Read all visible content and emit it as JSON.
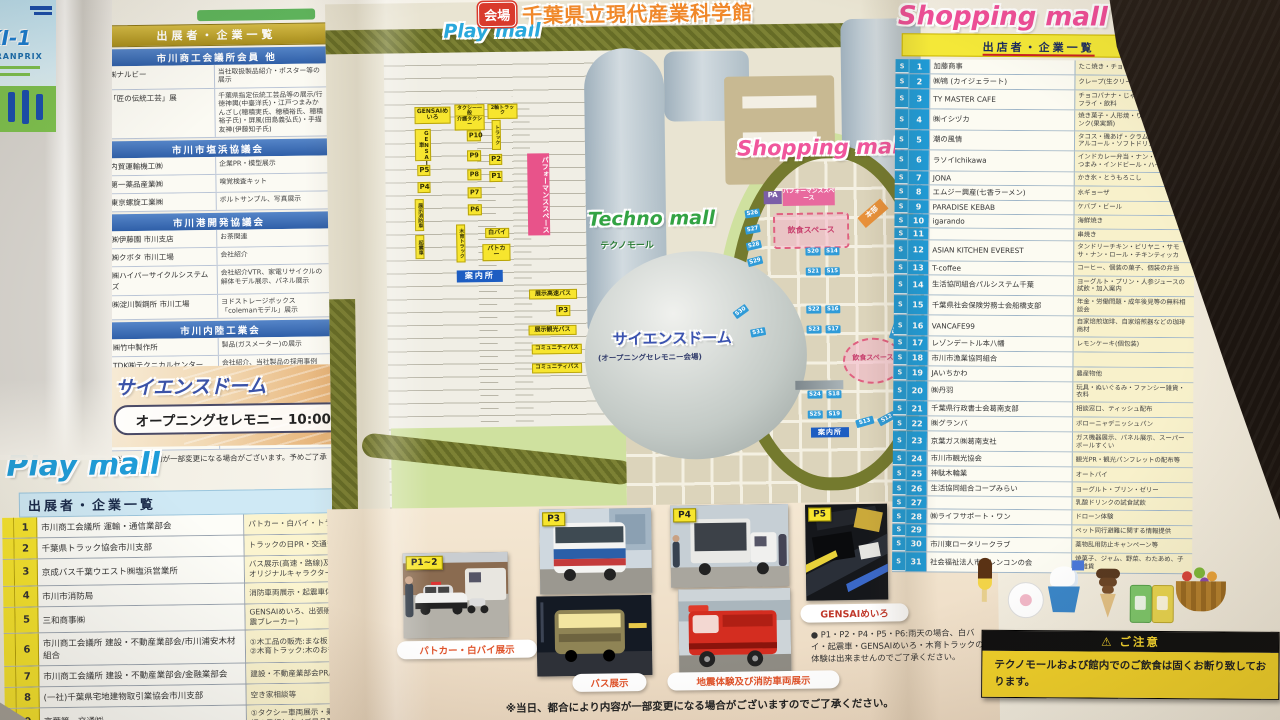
{
  "colors": {
    "play_blue": "#1f9cd8",
    "techno_green": "#33a344",
    "shopping_pink": "#f04f98",
    "title_orange": "#f0882a",
    "caution_yellow": "#f0d02a",
    "stall_blue": "#1f9bd7",
    "parking_yellow": "#f7e52e"
  },
  "header": {
    "badge": "会場",
    "title": "千葉県立現代産業科学館"
  },
  "flyer": {
    "line1": "KI-1",
    "line2": "GRANPRIX"
  },
  "exhibitors": {
    "title": "出展者・企業一覧",
    "note": "※当日、展示物が一部変更になる場合がございます。予めご了承ください。",
    "sections": [
      {
        "header": "市川商工会議所会員 他",
        "rows": [
          {
            "name": "㈱ナルビー",
            "desc": "当社取扱製品紹介・ポスター等の展示"
          },
          {
            "name": "「匠の伝統工芸」展",
            "desc": "千葉県指定伝統工芸品等の展示/行徳神輿(中臺洋氏)・江戸つまみかんざし(穂積実氏、穂積裕氏、穂積裕子氏)・屏風(田島義弘氏)・手描友禅(伊藤知子氏)"
          }
        ]
      },
      {
        "header": "市川市塩浜協議会",
        "rows": [
          {
            "name": "内貿運輸機工㈱",
            "desc": "企業PR・模型展示"
          },
          {
            "name": "第一薬品産業㈱",
            "desc": "嗅覚検査キット"
          },
          {
            "name": "東京螺旋工業㈱",
            "desc": "ボルトサンプル、写真展示"
          }
        ]
      },
      {
        "header": "市川港開発協議会",
        "rows": [
          {
            "name": "㈱伊藤園 市川支店",
            "desc": "お茶関連"
          },
          {
            "name": "㈱クボタ 市川工場",
            "desc": "会社紹介"
          },
          {
            "name": "㈱ハイパーサイクルシステムズ",
            "desc": "会社紹介VTR、家電リサイクルの解体モデル展示、パネル展示"
          },
          {
            "name": "㈱淀川製鋼所 市川工場",
            "desc": "ヨドストレージボックス「colemanモデル」展示"
          }
        ]
      },
      {
        "header": "市川内陸工業会",
        "rows": [
          {
            "name": "㈱竹中製作所",
            "desc": "製品(ガスメーター)の展示"
          },
          {
            "name": "TDK㈱テクニカルセンター",
            "desc": "会社紹介、当社製品の採用事例"
          }
        ]
      },
      {
        "header": "市川臨海工業会",
        "rows": [
          {
            "name": "東洋合成工業㈱",
            "desc": "パネル・製品関係(イメージ)の展示、会社紹介動画の放映など"
          },
          {
            "name": "㈱市川環境エンジニアリング",
            "desc": "パネル展示、会社案内動画放映、ワークショップ(グラスガーデン、ぷんぷんごま作り)"
          }
        ]
      }
    ]
  },
  "science_dome": {
    "title": "サイエンスドーム",
    "event": "オープニングセレモニー 10:00"
  },
  "play_mall": {
    "title": "Play mall",
    "subtitle": "出展者・企業一覧",
    "rows": [
      {
        "no": "1",
        "name": "市川商工会議所 運輸・通信業部会",
        "desc": "パトカー・白バイ・トラック展示"
      },
      {
        "no": "2",
        "name": "千葉県トラック協会市川支部",
        "desc": "トラックの日PR・交通安全・啓蒙活動"
      },
      {
        "no": "3",
        "name": "京成バス千葉ウエスト㈱塩浜営業所",
        "desc": "バス展示(高速・路線)及び乗車体験、グッズ販売 塩浜営業所オリジナルキャラクター「トラにゃ」交流会"
      },
      {
        "no": "4",
        "name": "市川市消防局",
        "desc": "消防車両展示・起震車体験"
      },
      {
        "no": "5",
        "name": "三和商事㈱",
        "desc": "GENSAIめいろ、出張販売Car GENSAI、防災用品の展示(感震ブレーカー)"
      },
      {
        "no": "6",
        "name": "市川商工会議所 建設・不動産業部会/市川浦安木材組合",
        "desc": "①木工品の販売:まな板・木のおもちゃ(木製品小物 展示販売) ②木育トラック:木のおもちゃ展示【体験】"
      },
      {
        "no": "7",
        "name": "市川商工会議所 建設・不動産業部会/金融業部会",
        "desc": "建設・不動産業部会PR/金融業部会PR"
      },
      {
        "no": "8",
        "name": "(一社)千葉県宅地建物取引業協会市川支部",
        "desc": "空き家相談等"
      },
      {
        "no": "9",
        "name": "京葉第一交通㈱",
        "desc": "①タクシー車両展示・乗車体験2台(介護、一般) ②子供乗務員証の発行とクイズ景品配布 ③タクマと記念撮影"
      }
    ]
  },
  "shopping_mall": {
    "title": "Shopping mall",
    "subtitle": "出店者・企業一覧",
    "rows": [
      {
        "s": "S",
        "no": "1",
        "name": "加藤商事",
        "desc": "たこ焼き・チョコバナナ"
      },
      {
        "s": "S",
        "no": "2",
        "name": "㈱鴇 (カイジェラート)",
        "desc": "クレープ(生クリーム不使用)"
      },
      {
        "s": "S",
        "no": "3",
        "name": "TY MASTER CAFE",
        "desc": "チョコバナナ・じゃがバター・ポテトフライ・飲料"
      },
      {
        "s": "S",
        "no": "4",
        "name": "㈱イシヅカ",
        "desc": "焼き菓子・人形焼・りんごあめ・ドリンク(果実類)"
      },
      {
        "s": "S",
        "no": "5",
        "name": "潮の風情",
        "desc": "タコス・磯あげ・クラムチャウダー・アルコール・ソフトドリンク"
      },
      {
        "s": "S",
        "no": "6",
        "name": "ラソイIchikawa",
        "desc": "インドカレー弁当・ナン・インド風おつまみ・インドビール・ハイボール"
      },
      {
        "s": "S",
        "no": "7",
        "name": "JONA",
        "desc": "かき氷・とうもろこし"
      },
      {
        "s": "S",
        "no": "8",
        "name": "エムジー興産(七香ラーメン)",
        "desc": "水ギョーザ"
      },
      {
        "s": "S",
        "no": "9",
        "name": "PARADISE KEBAB",
        "desc": "ケバブ・ビール"
      },
      {
        "s": "S",
        "no": "10",
        "name": "igarando",
        "desc": "海鮮焼き"
      },
      {
        "s": "S",
        "no": "11",
        "name": "",
        "desc": "串焼き"
      },
      {
        "s": "S",
        "no": "12",
        "name": "ASIAN KITCHEN EVEREST",
        "desc": "タンドリーチキン・ビリヤニ・サモサ・ナン・ロール・チキンティッカ"
      },
      {
        "s": "S",
        "no": "13",
        "name": "T-coffee",
        "desc": "コーヒー、個装の菓子、個装の弁当"
      },
      {
        "s": "S",
        "no": "14",
        "name": "生活協同組合パルシステム千葉",
        "desc": "ヨーグルト・プリン・人参ジュースの試飲・加入案内"
      },
      {
        "s": "S",
        "no": "15",
        "name": "千葉県社会保険労務士会船橋支部",
        "desc": "年金・労働問題・成年後見等の無料相談会"
      },
      {
        "s": "S",
        "no": "16",
        "name": "VANCAFE99",
        "desc": "自家焙煎珈琲、自家焙煎器などの珈琲商材"
      },
      {
        "s": "S",
        "no": "17",
        "name": "レゾンデートル本八幡",
        "desc": "レモンケーキ(個包装)"
      },
      {
        "s": "S",
        "no": "18",
        "name": "市川市漁業協同組合",
        "desc": ""
      },
      {
        "s": "S",
        "no": "19",
        "name": "JAいちかわ",
        "desc": "農産物他"
      },
      {
        "s": "S",
        "no": "20",
        "name": "㈱丹羽",
        "desc": "玩具・ぬいぐるみ・ファンシー雑貨・衣料"
      },
      {
        "s": "S",
        "no": "21",
        "name": "千葉県行政書士会葛南支部",
        "desc": "相談窓口、ティッシュ配布"
      },
      {
        "s": "S",
        "no": "22",
        "name": "㈱グランバ",
        "desc": "ボローニャデニッシュパン"
      },
      {
        "s": "S",
        "no": "23",
        "name": "京葉ガス㈱葛南支社",
        "desc": "ガス機器展示、パネル展示、スーパーボールすくい"
      },
      {
        "s": "S",
        "no": "24",
        "name": "市川市観光協会",
        "desc": "観光PR・観光パンフレットの配布等"
      },
      {
        "s": "S",
        "no": "25",
        "name": "神駄木輪業",
        "desc": "オートバイ"
      },
      {
        "s": "S",
        "no": "26",
        "name": "生活協同組合コープみらい",
        "desc": "ヨーグルト・プリン・ゼリー"
      },
      {
        "s": "S",
        "no": "27",
        "name": "",
        "desc": "乳酸ドリンクの試食試飲"
      },
      {
        "s": "S",
        "no": "28",
        "name": "㈱ライフサポート・ワン",
        "desc": "ドローン体験"
      },
      {
        "s": "S",
        "no": "29",
        "name": "",
        "desc": "ペット同行避難に関する情報提供"
      },
      {
        "s": "S",
        "no": "30",
        "name": "市川東ロータリークラブ",
        "desc": "薬物乱用防止キャンペーン等"
      },
      {
        "s": "S",
        "no": "31",
        "name": "社会福祉法人市川レンコンの会",
        "desc": "焼菓子、ジャム、野菜、わたあめ、子供雑貨"
      }
    ]
  },
  "map": {
    "area_labels": {
      "play_mall": "Play mall",
      "techno_mall": "Techno mall",
      "techno_mall_jp": "テクノモール",
      "shopping_mall": "Shopping mall",
      "science_dome": "サイエンスドーム",
      "science_dome_sub": "(オープニングセレモニー会場)"
    },
    "parking": [
      "GENSAIめいろ",
      "GENSAI車",
      "P5",
      "P4",
      "展示消防車",
      "起震車",
      "タクシー一般",
      "介護タクシー",
      "P10",
      "P9",
      "P8",
      "P7",
      "P6",
      "木育トラック",
      "2軸トラック",
      "トラック",
      "P2",
      "P1",
      "白バイ",
      "パトカー",
      "展示高速バス",
      "P3",
      "展示観光バス",
      "コミュニティバス",
      "コミュニティバス"
    ],
    "info": [
      "案内所",
      "案内所"
    ],
    "performance_label": "パフォーマンススペース",
    "pa": "PA",
    "honbu": "本部",
    "eat_space": "飲食スペース",
    "stalls_left": [
      "S26",
      "S27",
      "S28",
      "S29",
      "S30",
      "S31"
    ],
    "stalls_grid": [
      "S20",
      "S14",
      "S21",
      "S15",
      "S22",
      "S16",
      "S23",
      "S17",
      "S24",
      "S18",
      "S25",
      "S19"
    ],
    "stalls_right": [
      "S1",
      "S2",
      "S3",
      "S4",
      "S5",
      "S6",
      "S7",
      "S8",
      "S9",
      "S10",
      "S11",
      "S12",
      "S13"
    ]
  },
  "photo_strip": {
    "badges": [
      "P1~2",
      "P3",
      "P4",
      "P5"
    ],
    "captions": [
      "パトカー・白バイ展示",
      "バス展示",
      "地震体験及び消防車両展示",
      "GENSAIめいろ"
    ],
    "rain_note": "● P1・P2・P4・P5・P6:雨天の場合、白バイ・起震車・GENSAIめいろ・木育トラックの体験は出来ませんのでご了承ください。",
    "bottom_note": "※当日、都合により内容が一部変更になる場合がございますのでご了承ください。"
  },
  "caution": {
    "warning_icon": "⚠",
    "title": "ご注意",
    "body": "テクノモールおよび館内でのご飲食は固くお断り致しております。"
  }
}
